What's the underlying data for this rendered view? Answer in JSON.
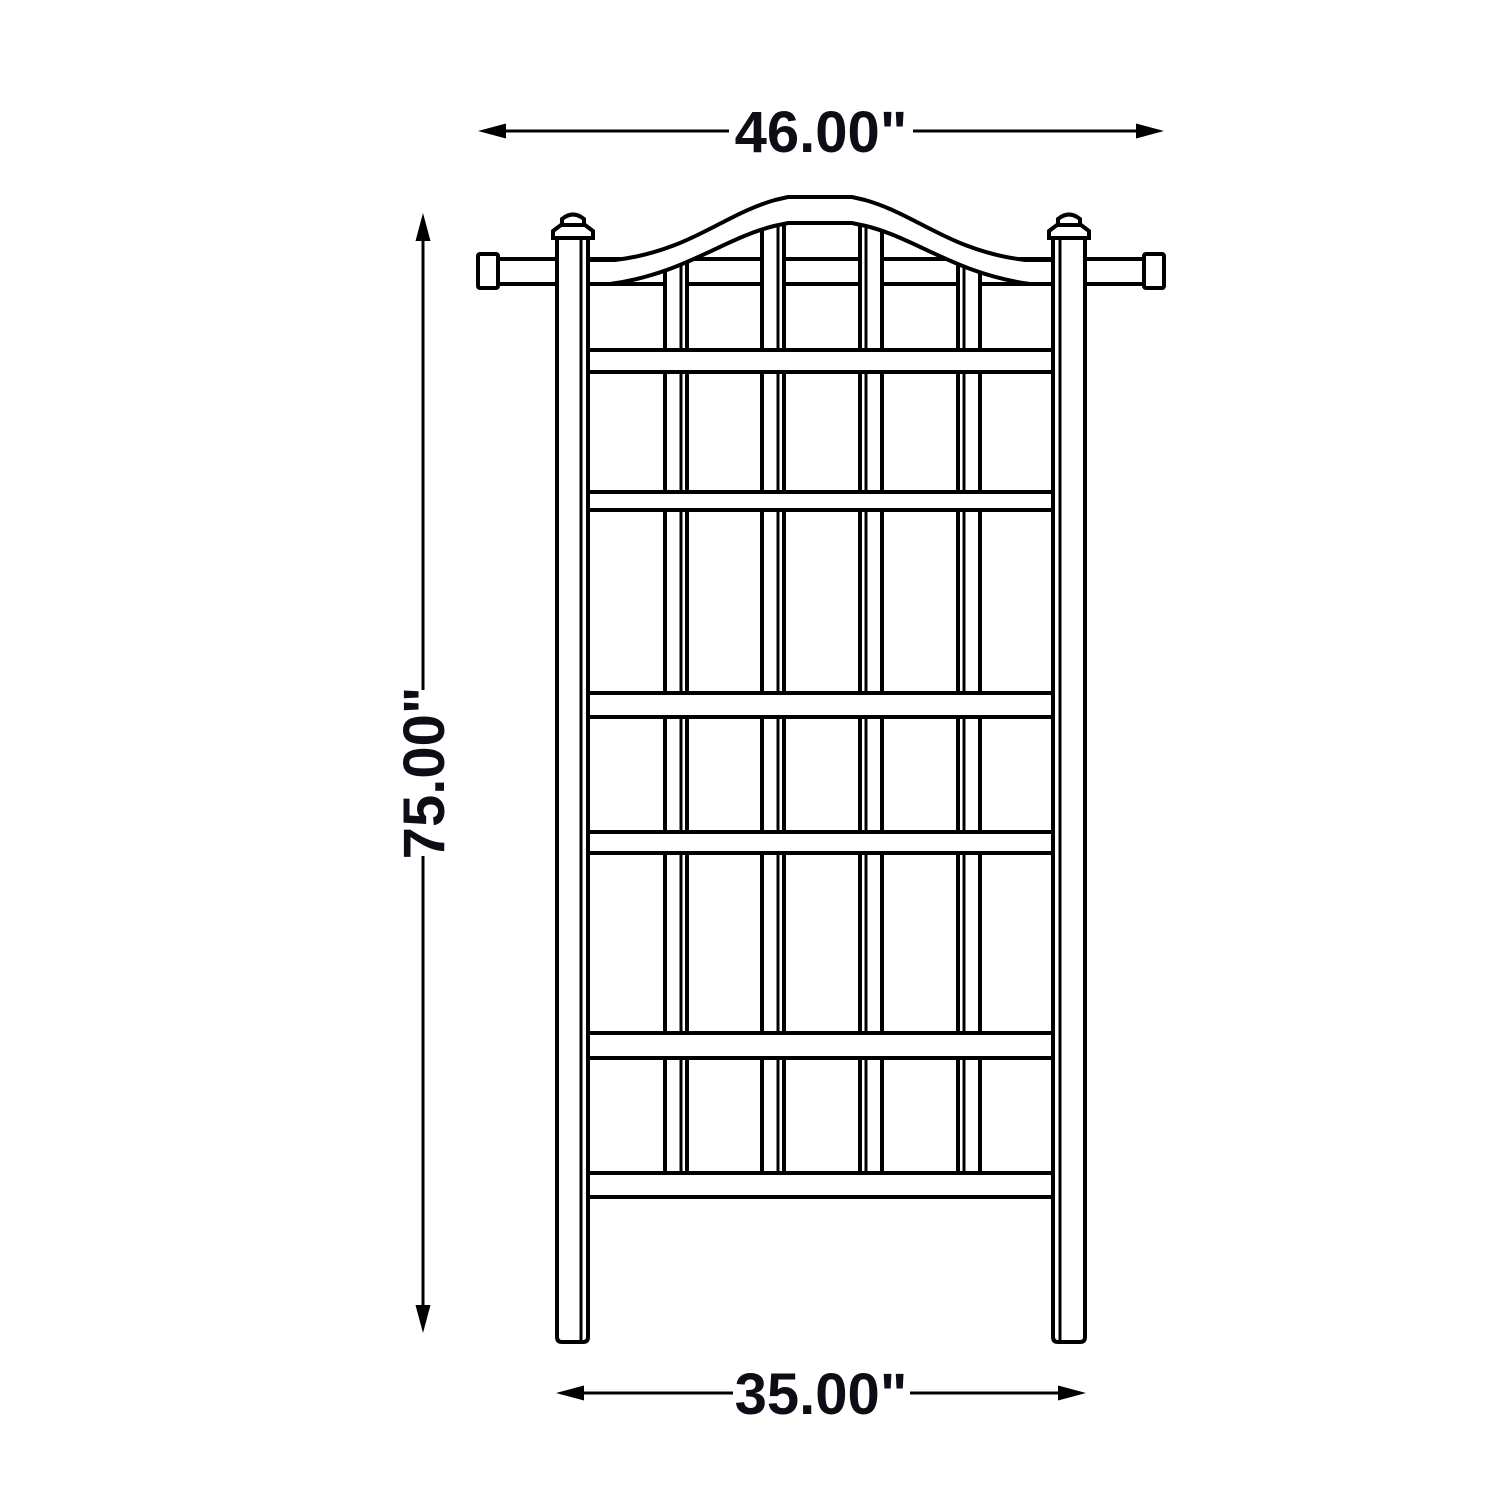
{
  "drawing": {
    "kind": "technical dimension drawing",
    "subject": "arched garden trellis - front elevation",
    "background_color": "#ffffff",
    "line_color": "#000000",
    "text_color": "#0d0d16",
    "dimensions": {
      "top_width": {
        "label": "46.00\"",
        "orientation": "horizontal"
      },
      "overall_height": {
        "label": "75.00\"",
        "orientation": "vertical"
      },
      "bottom_width": {
        "label": "35.00\"",
        "orientation": "horizontal"
      }
    },
    "structure": {
      "posts": 2,
      "inner_slats": 4,
      "horizontal_rails": 6,
      "top_feature": "arched header with crossbar and end caps",
      "post_finials": 2
    }
  }
}
